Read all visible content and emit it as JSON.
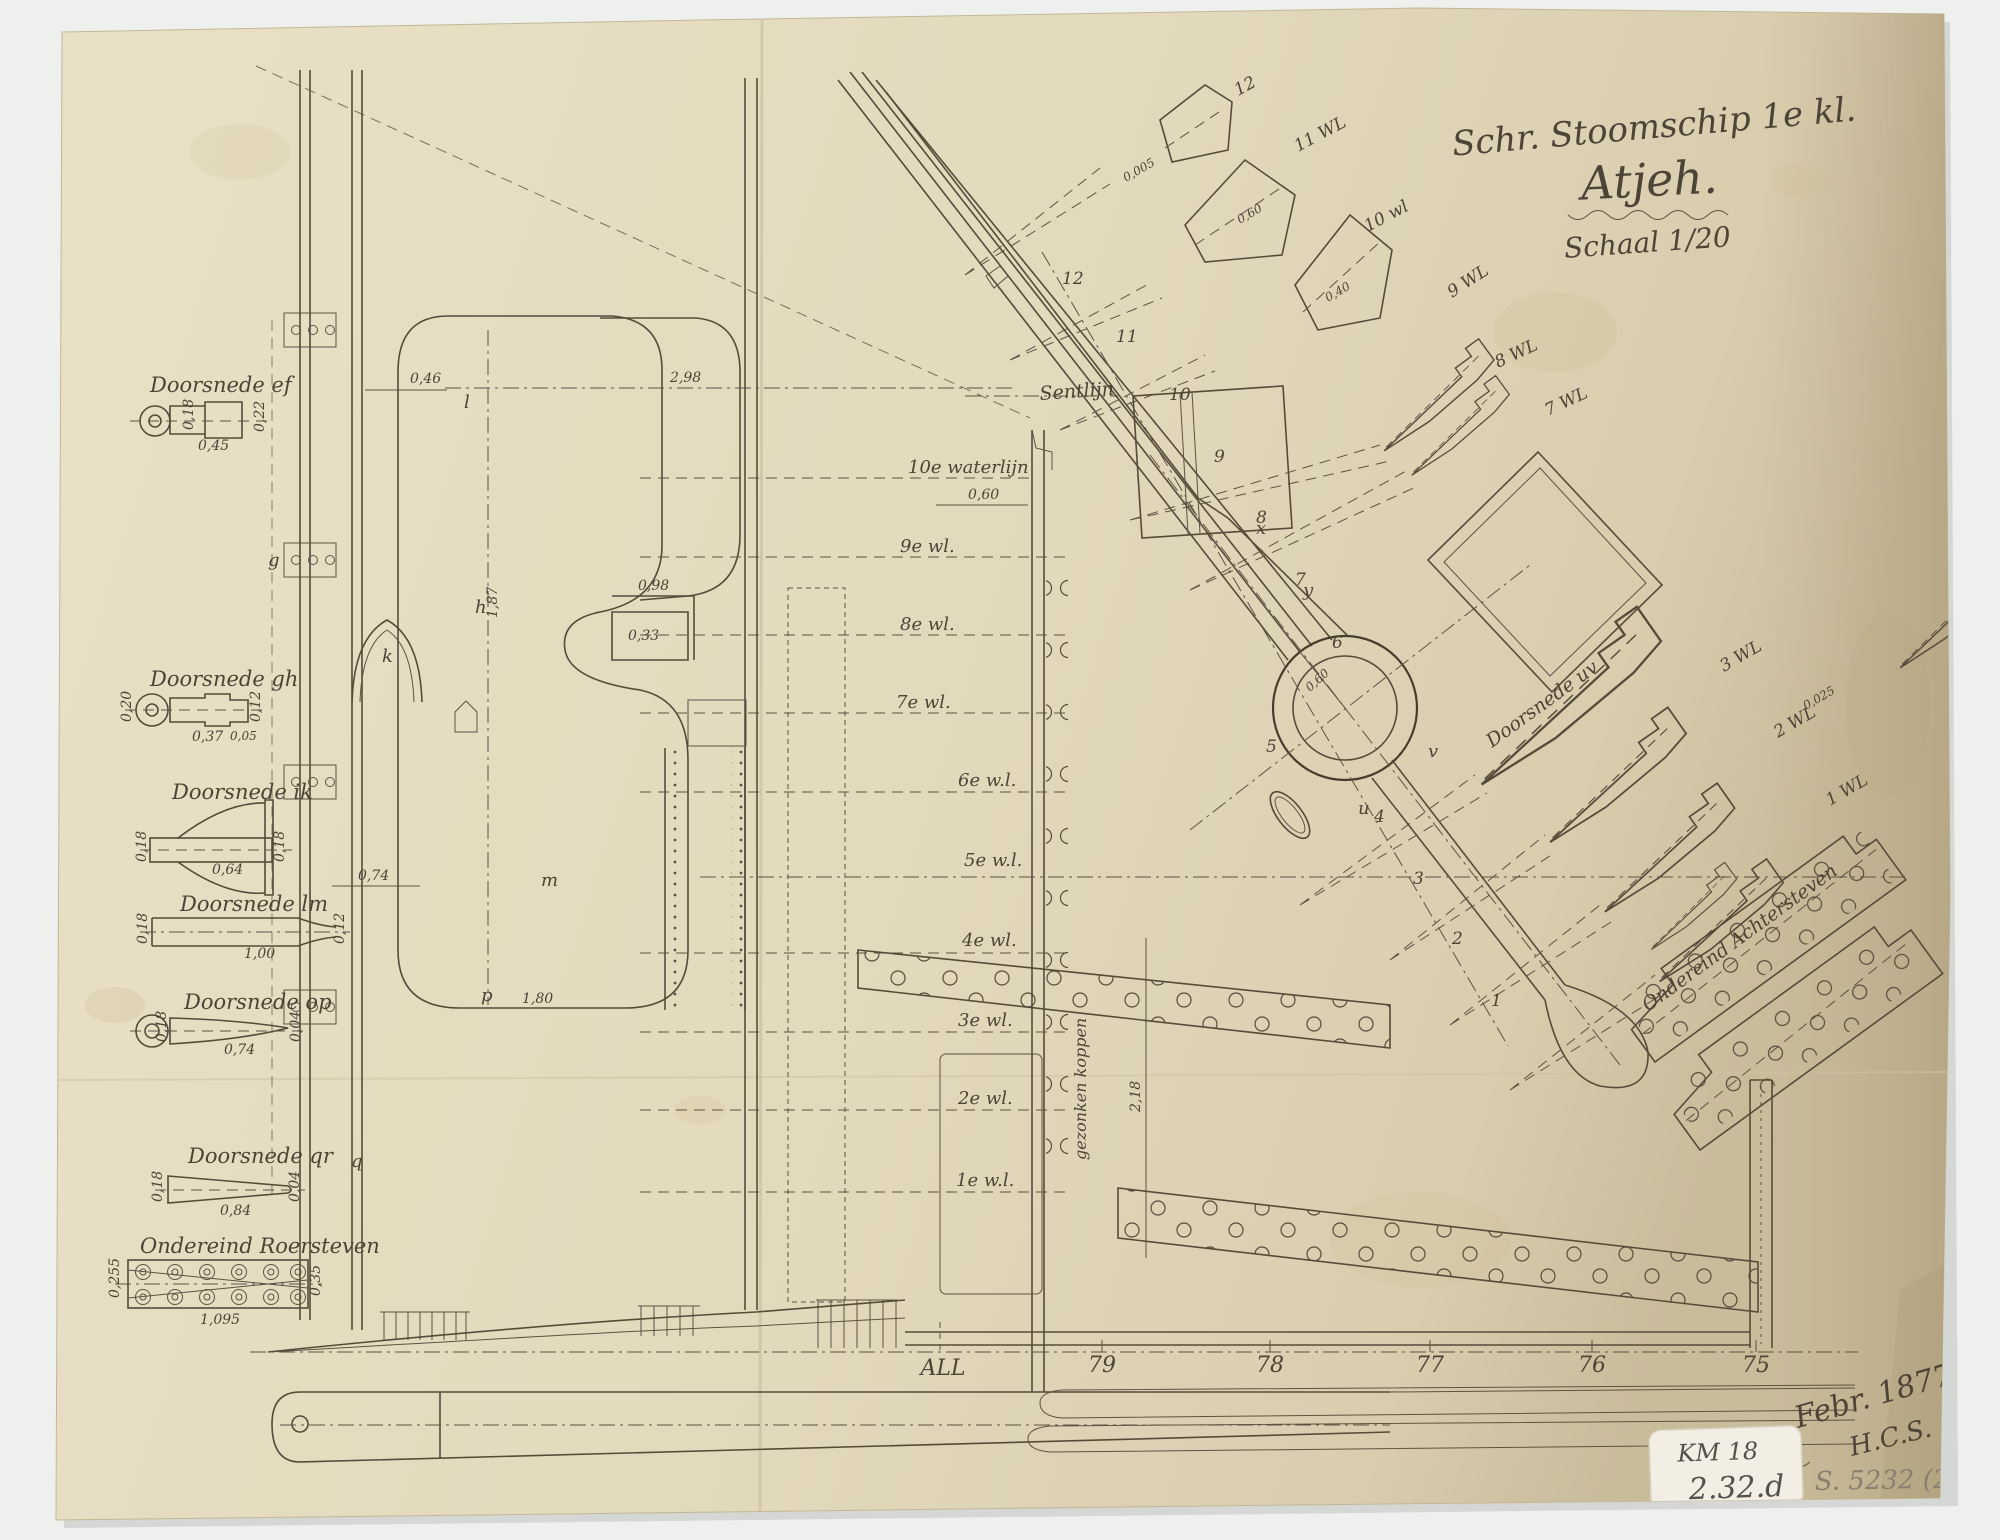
{
  "title_block": {
    "line1": "Schr. Stoomschip 1e kl.",
    "line2": "Atjeh.",
    "line3": "Schaal 1/20"
  },
  "left_sections": [
    {
      "label": "Doorsnede ef",
      "dims": [
        "0,18",
        "0,45",
        "0,22"
      ]
    },
    {
      "label": "Doorsnede gh",
      "dims": [
        "0,20",
        "0,37",
        "0,12",
        "0,05"
      ]
    },
    {
      "label": "Doorsnede ik",
      "dims": [
        "0,18",
        "0,64",
        "0,18"
      ]
    },
    {
      "label": "Doorsnede lm",
      "dims": [
        "0,18",
        "1,00",
        "0,12"
      ]
    },
    {
      "label": "Doorsnede op",
      "dims": [
        "0,18",
        "0,74",
        "0,04"
      ]
    },
    {
      "label": "Doorsnede qr",
      "dims": [
        "0,18",
        "0,84",
        "0,04"
      ]
    },
    {
      "label": "Ondereind Roersteven",
      "dims": [
        "0,255",
        "1,095",
        "0,35"
      ]
    }
  ],
  "waterlines": [
    "10e waterlijn",
    "9e wl.",
    "8e wl.",
    "7e wl.",
    "6e w.l.",
    "5e w.l.",
    "4e wl.",
    "3e wl.",
    "2e wl.",
    "1e w.l."
  ],
  "frames": [
    "ALL",
    "79",
    "78",
    "77",
    "76",
    "75"
  ],
  "diag_numbers": [
    "12",
    "11",
    "10",
    "9",
    "8",
    "7",
    "6",
    "5",
    "4",
    "3",
    "2",
    "1"
  ],
  "fan_labels": [
    "12",
    "11 WL",
    "10 wl",
    "9 WL",
    "8 WL",
    "7 WL"
  ],
  "right_fan_labels": [
    "3 WL",
    "2 WL",
    "1 WL"
  ],
  "curve_labels": {
    "sentlijn": "Sentlijn",
    "doorsnede_uv": "Doorsnede uv",
    "achtersteven": "Ondereind Achtersteven",
    "gezonken_koppen": "gezonken koppen"
  },
  "marker_letters": {
    "l": "l",
    "g": "g",
    "h": "h",
    "k": "k",
    "m": "m",
    "p": "p",
    "q": "q",
    "u": "u",
    "v": "v",
    "x": "x",
    "y": "y"
  },
  "dimensions": {
    "hull_width": "2,98",
    "stem_offset": "0,46",
    "wl_offset": "0,60",
    "lobe_height": "1,87",
    "bracket_width": "0,98",
    "bracket_height": "0,33",
    "frame_width": "0,74",
    "keel_length": "1,80",
    "post_height": "2,18",
    "plate_thick": "0,005",
    "taper": "0,40",
    "edge": "0,025",
    "boss_radius": "0,60"
  },
  "annotations": {
    "date": "Febr. 1877",
    "initials": "H.C.S.",
    "sticker_line1": "KM 18",
    "sticker_line2": "2.32.d",
    "archive_ref": "S. 5232 (23)"
  }
}
